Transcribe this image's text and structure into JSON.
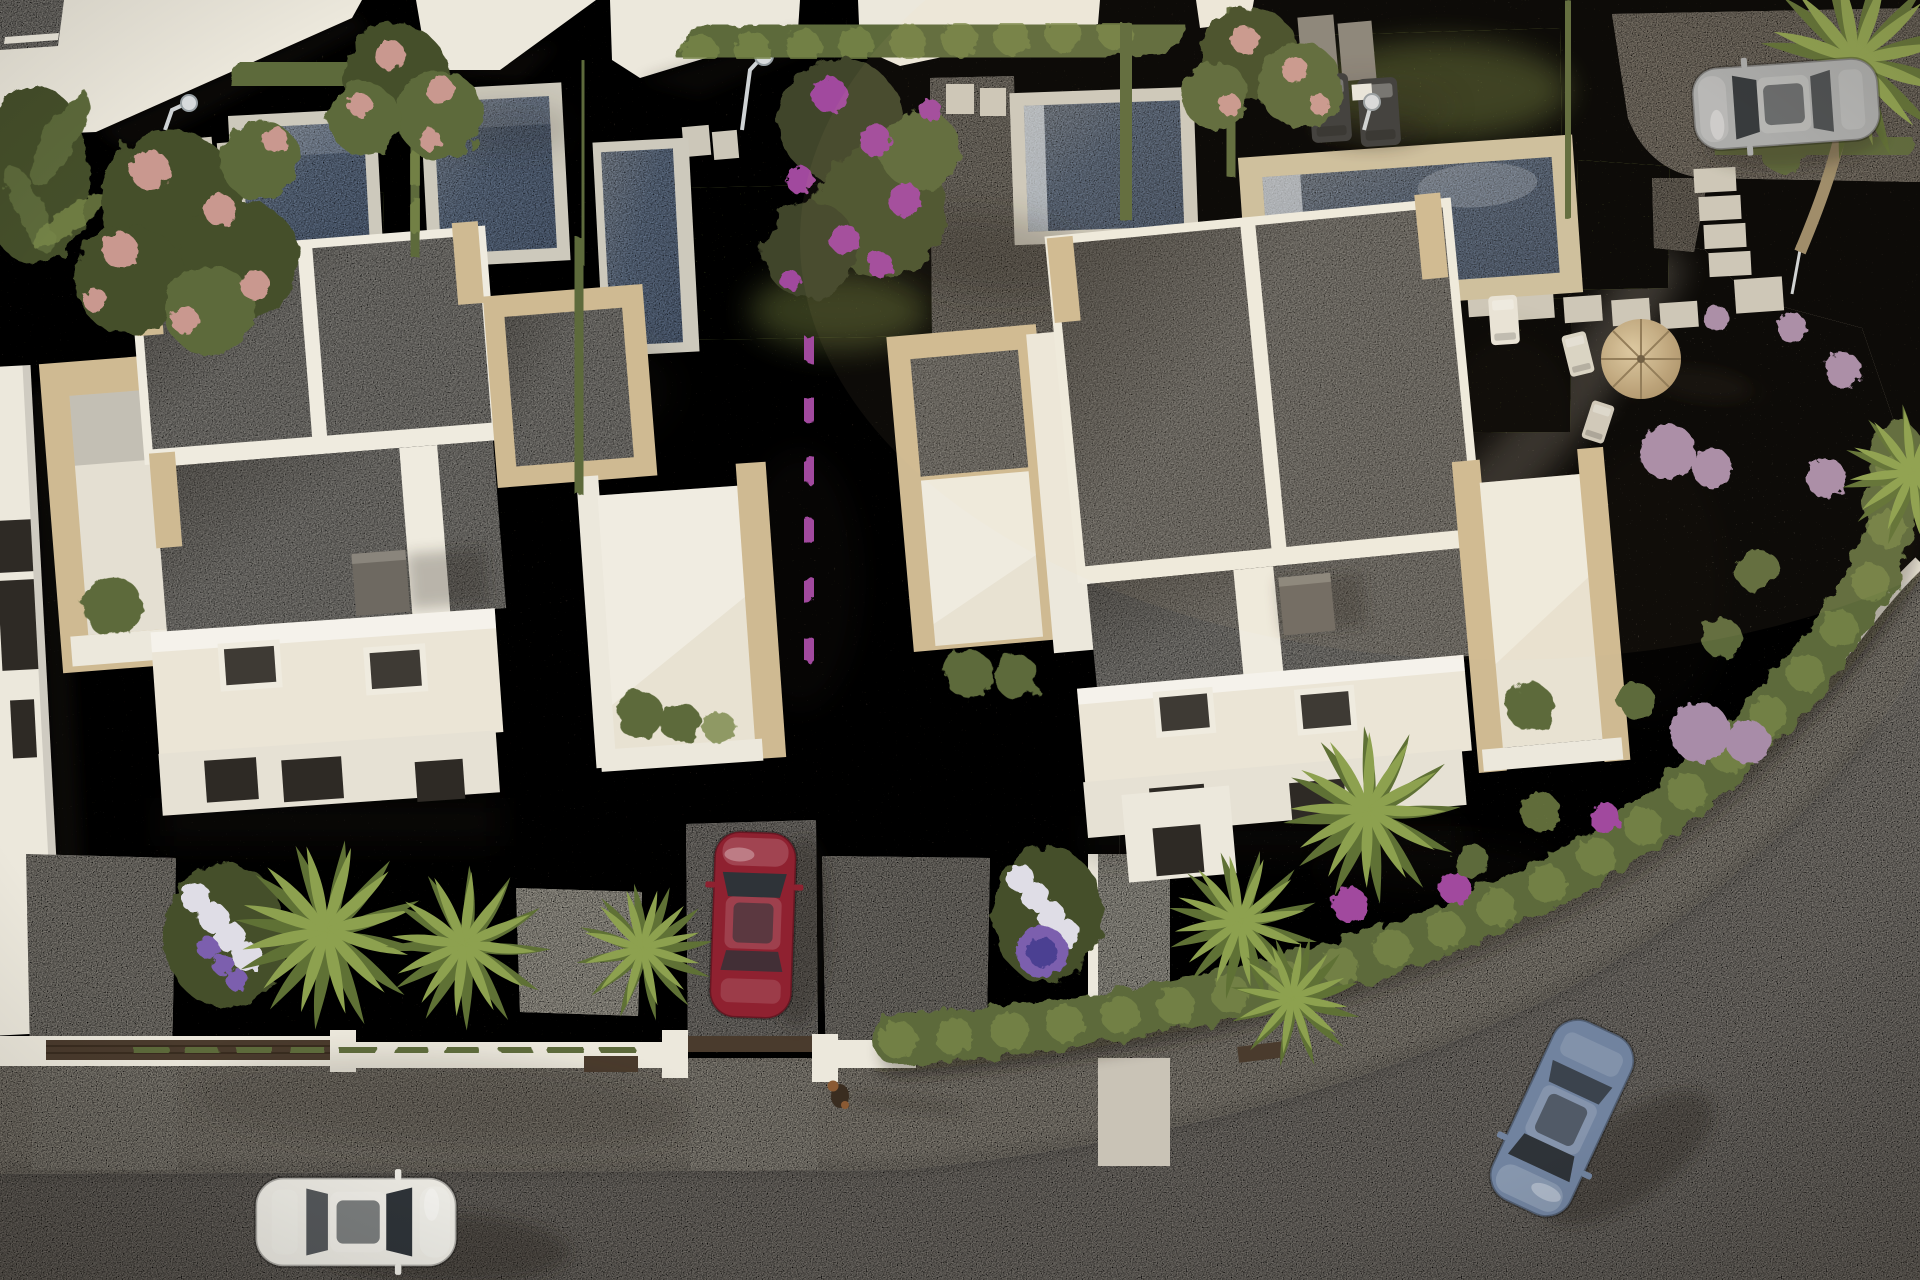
{
  "meta": {
    "description": "Aerial 3D render of a modern residential development on a corner plot: two white flat-roof villas with travertine trim, private pools and landscaped gardens, a curving street with sidewalk, four cars and a small dog.",
    "lighting": "low sun from the west; long shadows cast to the east"
  },
  "palette": {
    "gravel-dark": "#463e35",
    "gravel-mid": "#6b645a",
    "gravel-light": "#a79f93",
    "road": "#a8a29a",
    "road-light": "#b6b0a7",
    "sidewalk": "#bcb5a8",
    "curb-white": "#e9e5da",
    "wall-white": "#ece8dc",
    "fence-dark": "#4a3b2d",
    "lawn": "#5c6635",
    "lawn-light": "#74813f",
    "hedge": "#5d6b3a",
    "hedge-light": "#79884a",
    "hedge-dark": "#454f2a",
    "pool-water": "#8ea4c3",
    "pool-water-light": "#b9c5d5",
    "pool-coping": "#cdc9bc",
    "pool-coping-stone": "#cdbf9e",
    "stone-pale": "#ccc7b9",
    "roof-gray": "#b5b2ab",
    "parapet-white": "#efebdf",
    "roof-cream": "#ebe5d6",
    "stone-trim": "#cfba92",
    "chimney-gray": "#6e6961",
    "skylight-dark": "#3e3a34",
    "shadow": "#241d13",
    "palm-light": "#8da14f",
    "palm-dark": "#5f7135",
    "trunk": "#9b8a68",
    "flower-pink": "#c9988f",
    "flower-magenta": "#a14a9e",
    "flower-purple": "#7b5fae",
    "flower-white": "#dfdde6",
    "flower-mauve": "#a88ca8",
    "glass-dark": "#2e3338",
    "parasol": "#c7b088",
    "lounger-dark": "#3c3c3a"
  },
  "scene": {
    "villas": [
      {
        "id": "villa-left",
        "style": "modern white villa, speckled gray flat roof split by white parapets, travertine stone trim",
        "features": [
          "roof divider",
          "transverse parapet",
          "dark chimney box",
          "two skylights",
          "stone-framed left terrace",
          "stone porch and right terrace",
          "front wall with dark window slots"
        ]
      },
      {
        "id": "villa-right",
        "style": "matching modern white villa",
        "features": [
          "roof divider",
          "transverse parapet",
          "dark chimney box",
          "two skylights",
          "stone-framed left porch",
          "stone right terrace",
          "front entry volume"
        ]
      }
    ],
    "pools": [
      {
        "id": "pool-1",
        "plot": "upper left garden",
        "coping": "white"
      },
      {
        "id": "pool-2",
        "plot": "upper garden second plot",
        "coping": "white"
      },
      {
        "id": "pool-3",
        "plot": "narrow pool behind left villa, partly hidden by hedges",
        "coping": "white"
      },
      {
        "id": "pool-4",
        "plot": "behind right villa with gray L-shaped deck",
        "coping": "white"
      },
      {
        "id": "pool-5",
        "plot": "corner plot with lawn",
        "coping": "travertine"
      }
    ],
    "cars": [
      {
        "id": "red",
        "color_hex": "#8f2130",
        "location": "driveway between the villas",
        "heading": "north"
      },
      {
        "id": "white",
        "color_hex": "#e9e7e0",
        "location": "road, bottom left",
        "heading": "east"
      },
      {
        "id": "blue",
        "color_hex": "#71839f",
        "location": "road, rounding the corner",
        "heading": "southwest"
      },
      {
        "id": "silver",
        "color_hex": "#a8aaab",
        "location": "corner-plot driveway, top right",
        "heading": "west"
      }
    ],
    "animals": [
      {
        "id": "dog",
        "desc": "small brown dog walking on the sidewalk, long shadow"
      }
    ],
    "furniture": [
      "two dark sun loungers on corner lawn",
      "small white table",
      "straw parasol with two deck chairs",
      "white pool lounger",
      "three outdoor showers with pads"
    ],
    "vegetation": [
      "cypress privacy hedge between villas with purple bougainvillea",
      "boxwood hedges around plots",
      "fan palms in front gardens and corner",
      "banana plant top-left",
      "three pink flowering trees",
      "large purple flowering tree",
      "hydrangea flower beds",
      "mauve and magenta shrub balls in corner garden"
    ],
    "hardscape": [
      "stepping-stone paths",
      "white boundary walls with dark timber fence panels and gates",
      "speckled sidewalk with white curb wall",
      "light concrete driveways"
    ]
  }
}
